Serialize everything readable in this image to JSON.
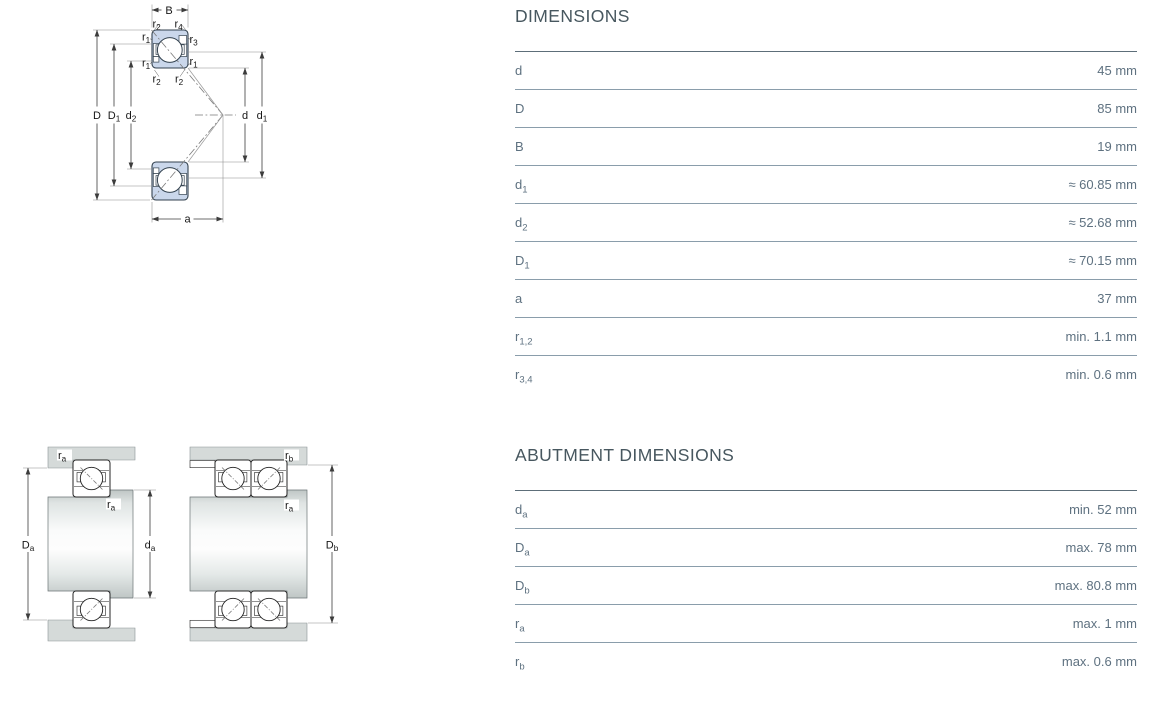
{
  "colors": {
    "bearing_fill": "#cad7eb",
    "bearing_stroke": "#33424f",
    "housing_fill": "#d5dad9",
    "heading_text": "#47575f",
    "table_text": "#5e7180",
    "rule_heavy": "#5d6e79",
    "rule_light": "#8a9dab"
  },
  "dimensions_table": {
    "title": "DIMENSIONS",
    "rows": [
      {
        "main": "d",
        "sub": "",
        "value": "45 mm"
      },
      {
        "main": "D",
        "sub": "",
        "value": "85 mm"
      },
      {
        "main": "B",
        "sub": "",
        "value": "19 mm"
      },
      {
        "main": "d",
        "sub": "1",
        "value": "≈ 60.85 mm"
      },
      {
        "main": "d",
        "sub": "2",
        "value": "≈ 52.68 mm"
      },
      {
        "main": "D",
        "sub": "1",
        "value": "≈ 70.15 mm"
      },
      {
        "main": "a",
        "sub": "",
        "value": "37 mm"
      },
      {
        "main": "r",
        "sub": "1,2",
        "value": "min. 1.1 mm"
      },
      {
        "main": "r",
        "sub": "3,4",
        "value": "min. 0.6 mm"
      }
    ]
  },
  "abutment_table": {
    "title": "ABUTMENT DIMENSIONS",
    "rows": [
      {
        "main": "d",
        "sub": "a",
        "value": "min. 52 mm"
      },
      {
        "main": "D",
        "sub": "a",
        "value": "max. 78 mm"
      },
      {
        "main": "D",
        "sub": "b",
        "value": "max. 80.8 mm"
      },
      {
        "main": "r",
        "sub": "a",
        "value": "max. 1 mm"
      },
      {
        "main": "r",
        "sub": "b",
        "value": "max. 0.6 mm"
      }
    ]
  },
  "figure_bearing": {
    "b": {
      "main": "B",
      "sub": ""
    },
    "r2_top_left": {
      "main": "r",
      "sub": "2"
    },
    "r4_top_right": {
      "main": "r",
      "sub": "4"
    },
    "r1_upper_left": {
      "main": "r",
      "sub": "1"
    },
    "r3_upper_right": {
      "main": "r",
      "sub": "3"
    },
    "r1_lower_left": {
      "main": "r",
      "sub": "1"
    },
    "r1_lower_right": {
      "main": "r",
      "sub": "1"
    },
    "r2_bottom_left": {
      "main": "r",
      "sub": "2"
    },
    "r2_bottom_right": {
      "main": "r",
      "sub": "2"
    },
    "D": {
      "main": "D",
      "sub": ""
    },
    "D1": {
      "main": "D",
      "sub": "1"
    },
    "d2": {
      "main": "d",
      "sub": "2"
    },
    "d": {
      "main": "d",
      "sub": ""
    },
    "d1": {
      "main": "d",
      "sub": "1"
    },
    "a": {
      "main": "a",
      "sub": ""
    }
  },
  "figure_abutment_single": {
    "ra_housing": {
      "main": "r",
      "sub": "a"
    },
    "ra_shaft": {
      "main": "r",
      "sub": "a"
    },
    "Da": {
      "main": "D",
      "sub": "a"
    },
    "da": {
      "main": "d",
      "sub": "a"
    }
  },
  "figure_abutment_paired": {
    "rb": {
      "main": "r",
      "sub": "b"
    },
    "ra": {
      "main": "r",
      "sub": "a"
    },
    "Db": {
      "main": "D",
      "sub": "b"
    }
  }
}
